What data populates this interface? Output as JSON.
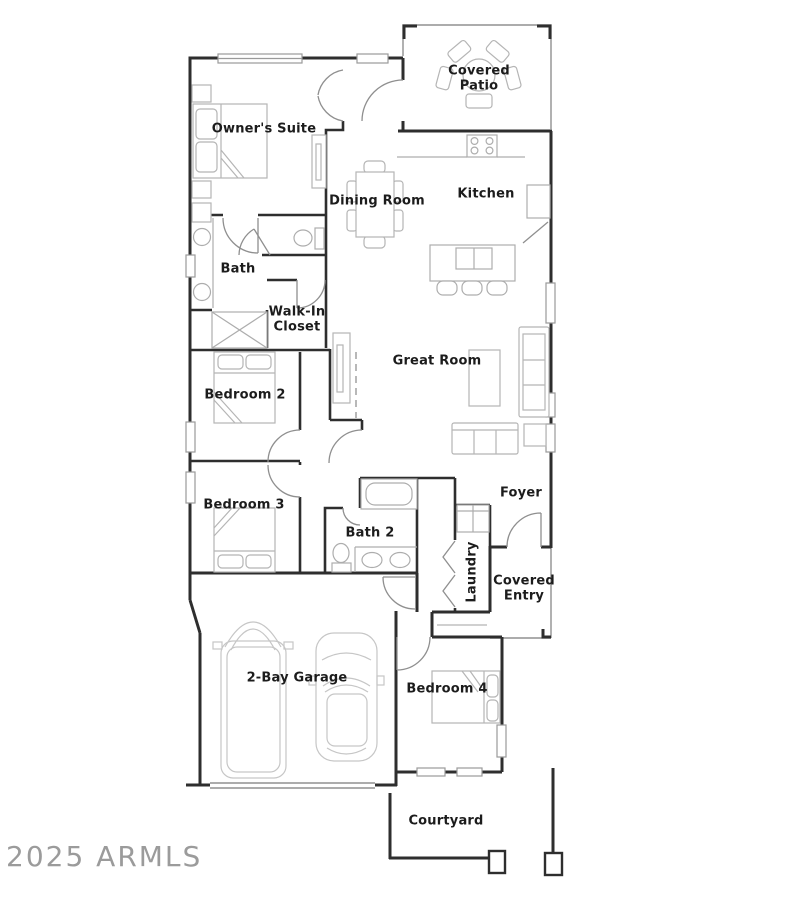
{
  "floor_plan": {
    "rooms": {
      "covered_patio": "Covered Patio",
      "owners_suite": "Owner's Suite",
      "dining_room": "Dining Room",
      "kitchen": "Kitchen",
      "bath": "Bath",
      "walk_in_closet": "Walk-In Closet",
      "bedroom_2": "Bedroom 2",
      "great_room": "Great Room",
      "bedroom_3": "Bedroom 3",
      "bath_2": "Bath 2",
      "foyer": "Foyer",
      "laundry": "Laundry",
      "covered_entry": "Covered Entry",
      "garage": "2-Bay Garage",
      "bedroom_4": "Bedroom 4",
      "courtyard": "Courtyard"
    },
    "watermark": "2025 ARMLS",
    "colors": {
      "walls": "#2e2e2e",
      "fixtures": "#b5b5b5",
      "door_swings": "#8f8f8f",
      "label_text": "#1c1c1c",
      "watermark_text": "#9b9b9b",
      "background": "#ffffff"
    }
  }
}
